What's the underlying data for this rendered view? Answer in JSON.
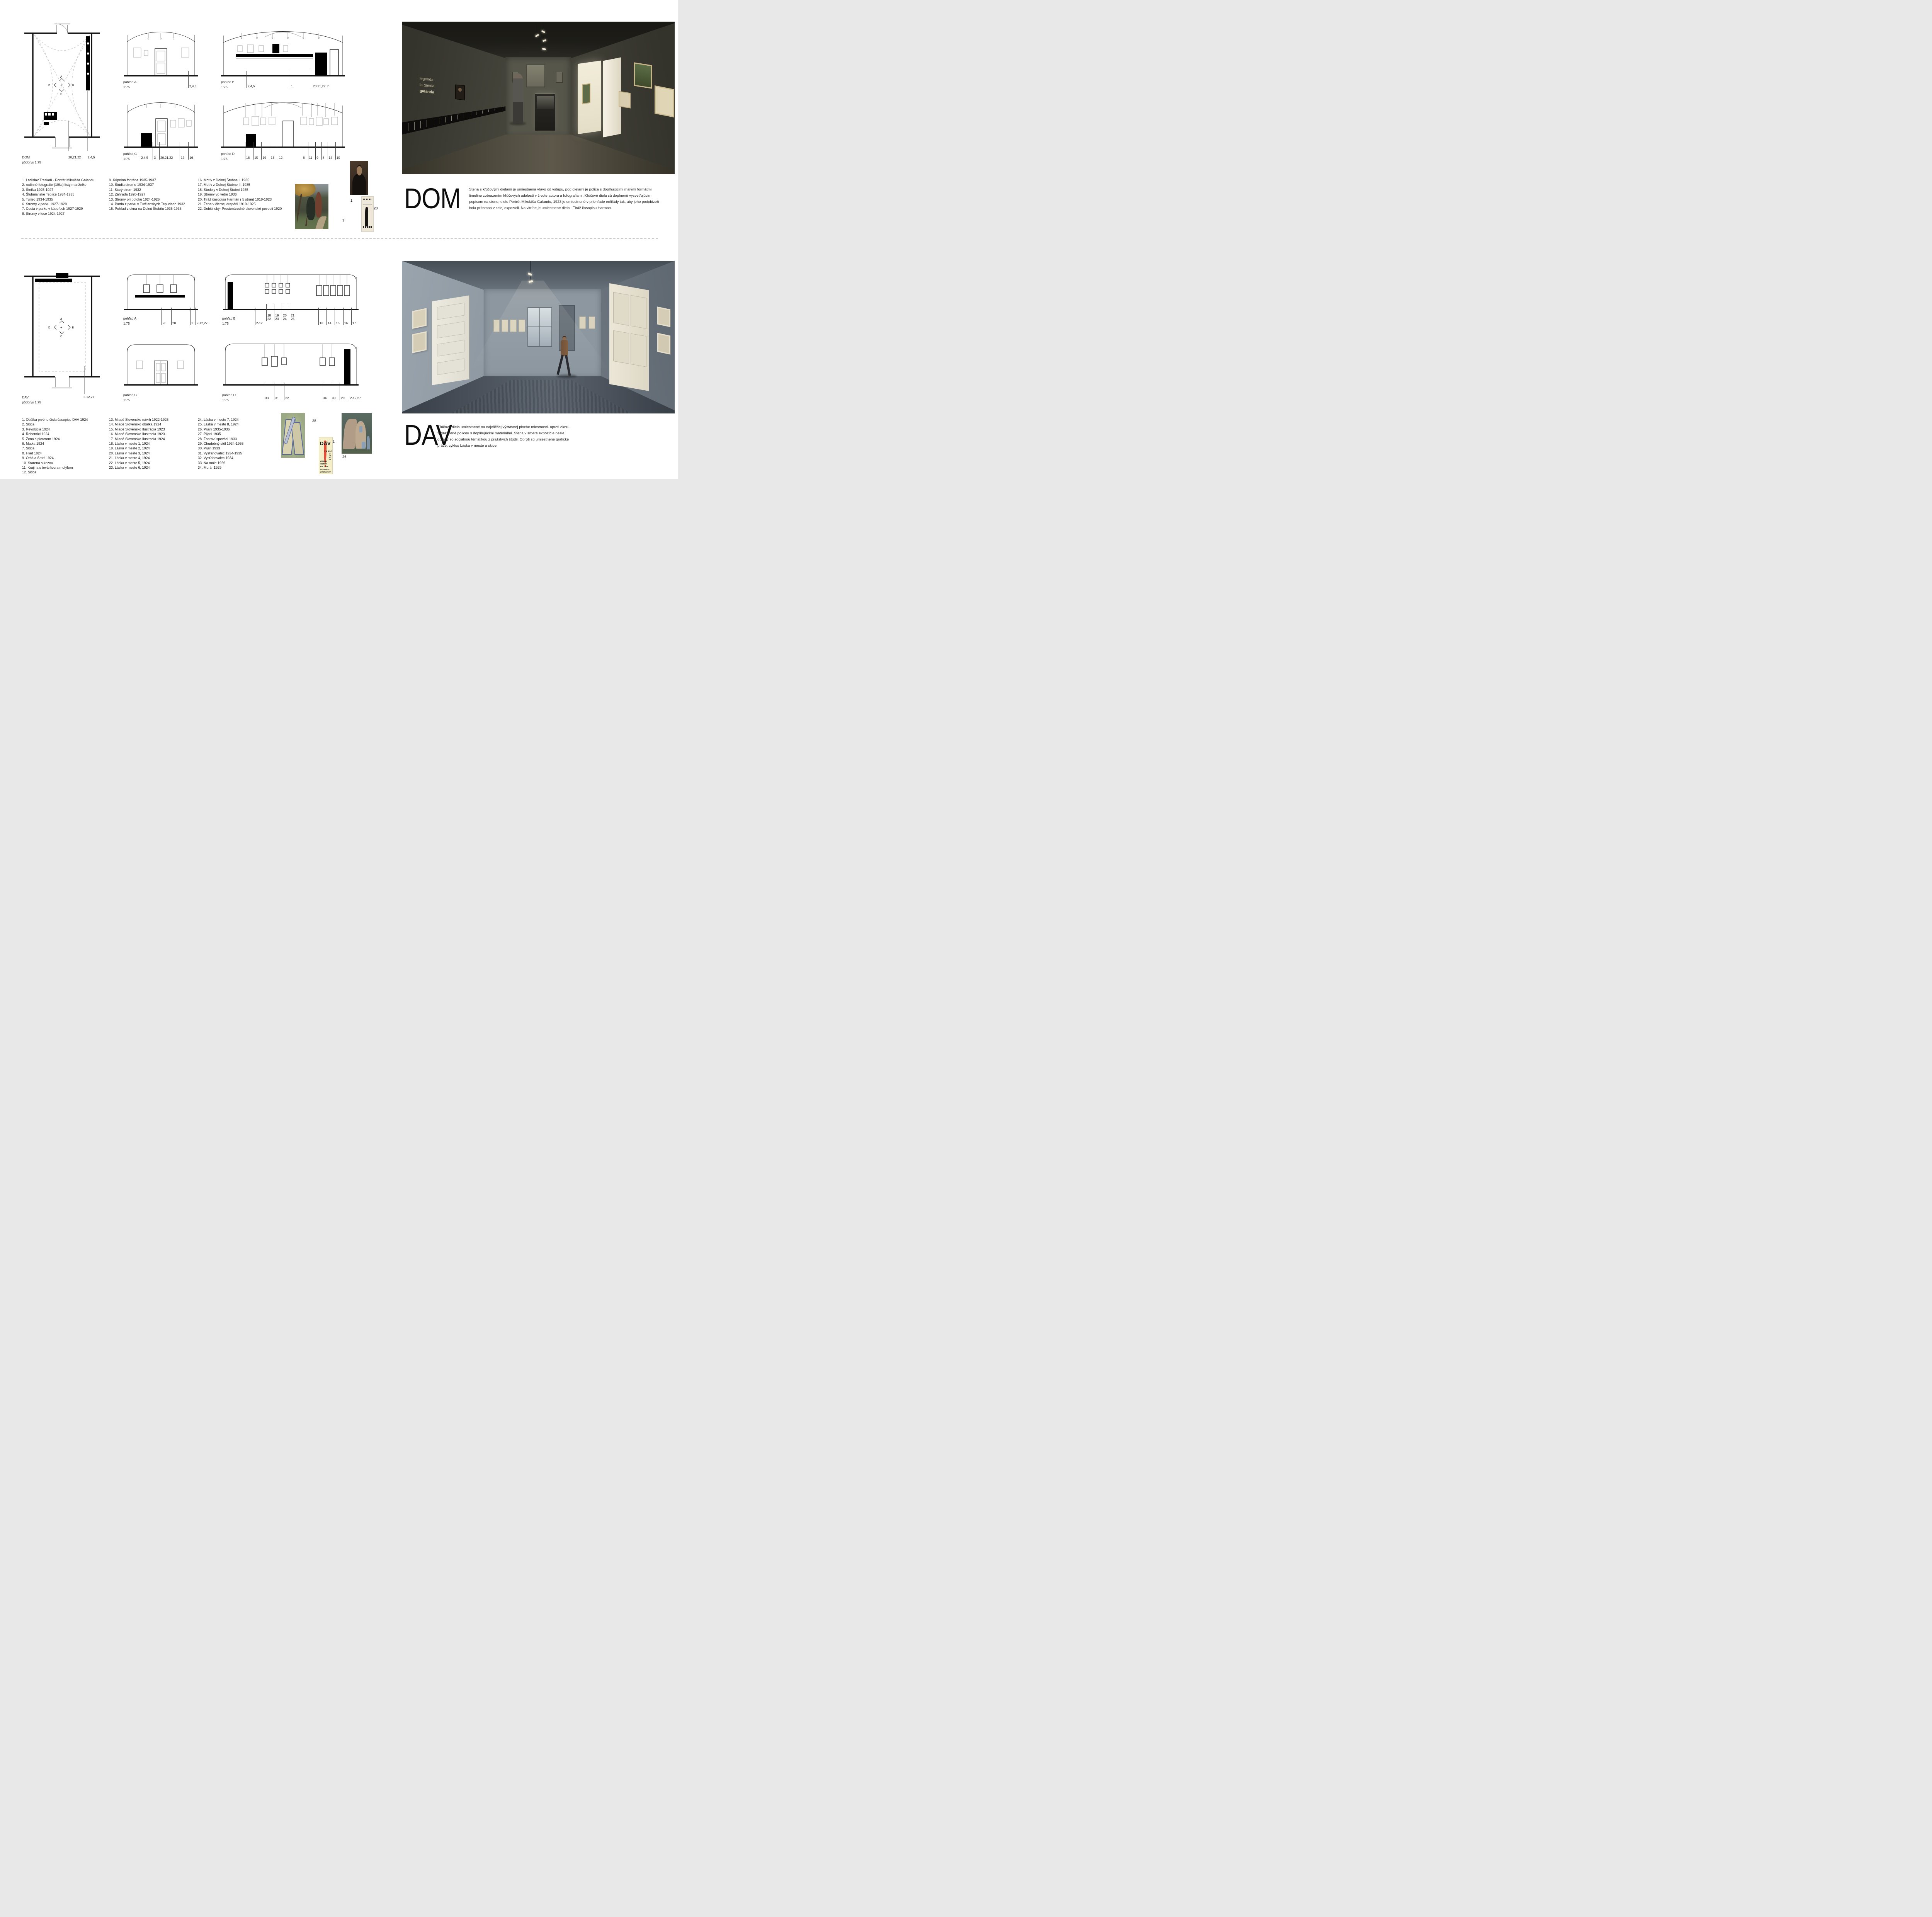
{
  "compass": {
    "up": "A",
    "right": "B",
    "down": "C",
    "left": "D"
  },
  "colors": {
    "accent_red": "#df4f3a",
    "cover_paper": "#f4eec9",
    "line": "#1a1a1a",
    "dashed_guide": "#c6c6c6"
  },
  "dom": {
    "title": "DOM",
    "description": "Stena s kľúčovými dielami je umiestnená vľavo od vstupu, pod dielami je polica s doplňujúcimi malými formátmi, timeline zobrazením kľúčových udalostí v živote autora a fotografiami. Kľúčové diela sú doplnené vysvetľujúcim popisom na stene, dielo Portrét Mikuláša Galandu, 1923 je umiestnené v priehľade enfilády tak, aby jeho podobizeň bola prítomná v celej expozícii. Na vitríne je umiestnené dielo - Tiráž časopisu Harmán.",
    "plan": {
      "name": "DOM",
      "scale": "pôdorys 1:75",
      "callouts": [
        "20,21,22",
        "2,4,5"
      ]
    },
    "views": [
      {
        "label": "pohľad A",
        "scale": "1:75",
        "callouts": [
          [
            "2,4,5"
          ]
        ]
      },
      {
        "label": "pohľad B",
        "scale": "1:75",
        "callouts": [
          [
            "2,4,5"
          ],
          [
            "1"
          ],
          [
            "20,21,22"
          ],
          [
            "7"
          ]
        ]
      },
      {
        "label": "pohľad C",
        "scale": "1:75",
        "callouts": [
          [
            "2,4,5",
            "3"
          ],
          [
            "20,21,22"
          ],
          [
            "17",
            "16"
          ]
        ]
      },
      {
        "label": "pohľad D",
        "scale": "1:75",
        "callouts": [
          [
            "18",
            "15",
            "19",
            "13",
            "12"
          ],
          [
            "6",
            "11",
            "9",
            "8",
            "14",
            "10"
          ]
        ]
      }
    ],
    "list_columns": [
      [
        "1. Ladislav Treskoň - Portrét Mikuláša Galandu",
        "2. rodinné fotografie (10ks) listy manželke",
        "3. Štefka 1925-1927",
        "4. Štubnianske Teplice 1934-1935",
        "5. Turiec 1934-1935",
        "6. Stromy v parku 1927-1929",
        "7. Cesta v parku v kúpeľoch 1927-1929",
        "8. Stromy v lese 1924-1927"
      ],
      [
        "9. Kúpeľná fontána 1935-1937",
        "10. Štúdia stromu 1934-1937",
        "11. Starý strom 1932",
        "12. Záhrada 1920-1927",
        "13. Stromy pri potoku 1924-1926",
        "14. Partia z parku v Turčianskych Tepliciach 1932",
        "15. Pohľad z okna na Dolnú Štubňu 1935-1936"
      ],
      [
        "16. Motív z Dolnej Štubne I. 1935",
        "17. Motív z Dolnej Štubne II. 1935",
        "18. Stodoly v Dolnej Štubni 1935",
        "19. Stromy vo vetre 1936",
        "20. Tiráž časopisu Harmán ( 5 strán) 1919-1923",
        "21. Žena v čiernej drapérii 1919-1925",
        "22. Dobšinský- Prostonárodné slovenské povesti 1920"
      ]
    ],
    "figure_labels": {
      "landscape": "7",
      "portrait": "1",
      "print": "20"
    },
    "render": {
      "wall_text": [
        "legenda",
        "la ganda",
        "galanda"
      ]
    }
  },
  "dav": {
    "title": "DAV",
    "description": "Kľúčové diela umiestnené na najväčšej výstavnej ploche miestnosti- oproti oknu- zvýraznené policou s doplňujúcimi materiálmi. Stena v smere expozície nesie obrazy so sociálnou tématikou z pražských štúdii. Oproti sú umiestnené grafické práce, cyklus Láska v meste a skice.",
    "plan": {
      "name": "DAV",
      "scale": "pôdorys 1:75",
      "callouts": [
        "2-12,27"
      ]
    },
    "views": [
      {
        "label": "pohľad A",
        "scale": "1:75",
        "callouts": [
          [
            "26"
          ],
          [
            "28"
          ],
          [
            "1"
          ],
          [
            "2-12,27"
          ]
        ]
      },
      {
        "label": "pohľad B",
        "scale": "1:75",
        "callouts": [
          [
            "2-12"
          ],
          [
            "18\n22",
            "19\n23",
            "20\n24",
            "21\n25"
          ],
          [
            "13",
            "14",
            "15",
            "16",
            "17"
          ]
        ]
      },
      {
        "label": "pohľad C",
        "scale": "1:75",
        "callouts": []
      },
      {
        "label": "pohľad D",
        "scale": "1:75",
        "callouts": [
          [
            "33",
            "31",
            "32"
          ],
          [
            "34",
            "30",
            "29",
            "2-12,27"
          ]
        ]
      }
    ],
    "list_columns": [
      [
        "1. Obálka prvého čísla časopisu DAV 1924",
        "2. Skica",
        "3. Revolúcia 1924",
        "4. Robotníci 1924",
        "5. Žena s pierotom 1924",
        "6. Matka 1924",
        "7. Skica",
        "8. Hlad 1924",
        "9. Oráč a Smrť 1924",
        "10. Starena s kozou",
        "11. Krajina s továrňou a motýľom",
        "12. Skica"
      ],
      [
        "13. Mladé Slovensko návrh 1922-1925",
        "14. Mladé Slovensko obálka 1924",
        "15. Mladé Slovensko Ilustrácia 1923",
        "16. Mladé Slovensko Ilustrácia 1923",
        "17. Mladé Slovensko Ilustrácia 1924",
        "18. Láska v meste 1, 1924",
        "19. Láska v meste 2, 1924",
        "20. Láska v meste 3, 1924",
        "21. Láska v meste 4, 1924",
        "22. Láska v meste 5, 1924",
        "23. Láska v meste 6, 1924"
      ],
      [
        "24. Láska v meste 7, 1924",
        "25. Láska v meste 8, 1924",
        "26. Pijani 1935-1936",
        "27. Pijani 1935",
        "28. Žobraví speváci 1933",
        "29. Chudobný stôl 1934-1936",
        "30. Pijan 1933",
        "31. Vysťahovalec 1934-1935",
        "32. Vysťahovalec 1934",
        "33. Na móle 1926",
        "34. Murár 1929"
      ]
    ],
    "figure_labels": {
      "cubist": "28",
      "cover": "1",
      "drinkers": "26"
    },
    "cover": {
      "title": "DAV",
      "season": "JARO",
      "year": "1925",
      "subjects": [
        "UMENIE",
        "KRITIKA",
        "POLITIKA",
        "FILOZOFIA",
        "LITERATURA"
      ]
    }
  }
}
